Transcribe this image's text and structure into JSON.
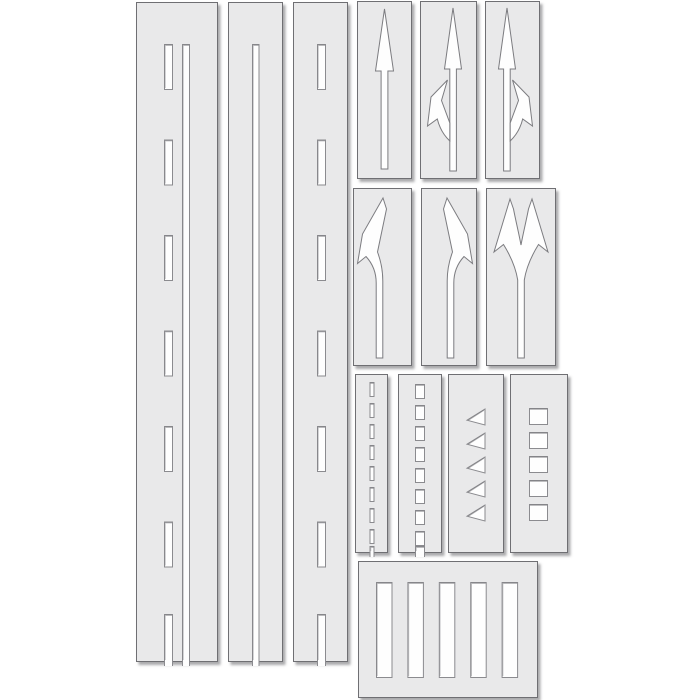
{
  "image": {
    "description": "road-marking stencil kit product sheet",
    "width": 700,
    "height": 700,
    "background": "#ffffff"
  },
  "colors": {
    "panel_fill": "#e9e9ea",
    "panel_stroke": "#6f6f73",
    "cutout_fill": "#fefefe",
    "cutout_stroke": "#8b8b8f",
    "cutout_shade": "#55555a"
  },
  "panels": [
    {
      "name": "stencil-strip-dashed-plus-solid-line",
      "x": 136,
      "y": 2,
      "w": 82,
      "h": 660,
      "cutouts": [
        {
          "kind": "rect-column",
          "x": 28,
          "w": 9,
          "start": 42,
          "len": 46,
          "pitch": 95.5,
          "count": 6,
          "open_from": 612
        },
        {
          "kind": "slot",
          "x": 46,
          "w": 8,
          "top": 42
        }
      ]
    },
    {
      "name": "stencil-strip-solid-line",
      "x": 228,
      "y": 2,
      "w": 55,
      "h": 660,
      "cutouts": [
        {
          "kind": "slot",
          "x": 24,
          "w": 7.5,
          "top": 42
        }
      ]
    },
    {
      "name": "stencil-strip-dashed-line",
      "x": 293,
      "y": 2,
      "w": 55,
      "h": 660,
      "cutouts": [
        {
          "kind": "rect-column",
          "x": 24,
          "w": 9,
          "start": 42,
          "len": 46,
          "pitch": 95.5,
          "count": 6,
          "open_from": 612
        }
      ]
    },
    {
      "name": "stencil-arrow-straight",
      "x": 357,
      "y": 1,
      "w": 55,
      "h": 178,
      "cutouts": [
        {
          "kind": "path",
          "shape": "straight-arrow-cutout",
          "d": "M27.5 8 L36.5 70 L30.9 70 L30.9 168 L24.1 168 L24.1 70 L18.5 70 Z"
        }
      ]
    },
    {
      "name": "stencil-arrow-straight-or-left",
      "x": 420,
      "y": 1,
      "w": 57,
      "h": 178,
      "cutouts": [
        {
          "kind": "path",
          "shape": "straight-arrow-cutout",
          "d": "M33 7 L41.5 68 L36.4 68 L36.4 170 L29.8 170 L29.8 68 L24.5 68 Z"
        },
        {
          "kind": "path",
          "shape": "left-branch-arrow-cutout",
          "d": "M29.8 140 C23.5 134 19.5 127 17.3 118 L7.5 125 L11 96 L27.5 79 L21.5 99.5 C23.5 105 26.5 113 29.8 122 Z"
        }
      ]
    },
    {
      "name": "stencil-arrow-straight-or-right",
      "x": 485,
      "y": 1,
      "w": 55,
      "h": 178,
      "cutouts": [
        {
          "kind": "path",
          "shape": "straight-arrow-cutout",
          "d": "M22 7 L30.5 68 L25.2 68 L25.2 170 L18.6 170 L18.6 68 L13.5 68 Z"
        },
        {
          "kind": "path",
          "shape": "right-branch-arrow-cutout",
          "d": "M25.2 140 C31.5 134 35.5 127 37.7 118 L47.5 125 L44 96 L27.5 79 L33.5 99.5 C31.5 105 28.5 113 25.2 122 Z"
        }
      ]
    },
    {
      "name": "stencil-arrow-turn-left",
      "x": 353,
      "y": 188,
      "w": 59,
      "h": 178,
      "cutouts": [
        {
          "kind": "path",
          "shape": "turn-left-arrow-cutout",
          "d": "M30 10 L33.5 21 L24.5 64 C27.5 72 29.8 82 29.8 93 L29.8 170 L23.2 170 L23.2 95 C23.2 84 19 75 13 68.5 L4.5 75.5 L9.5 46 Z"
        }
      ]
    },
    {
      "name": "stencil-arrow-turn-right",
      "x": 421,
      "y": 188,
      "w": 56,
      "h": 178,
      "cutouts": [
        {
          "kind": "path",
          "shape": "turn-right-arrow-cutout",
          "d": "M26 10 L22.5 21 L31.5 64 C28.5 72 26.2 82 26.2 93 L26.2 170 L32.8 170 L32.8 95 C32.8 84 37 75 43 68.5 L51.5 75.5 L46.5 46 Z"
        }
      ]
    },
    {
      "name": "stencil-arrow-fork-left-right",
      "x": 486,
      "y": 188,
      "w": 70,
      "h": 178,
      "cutouts": [
        {
          "kind": "path",
          "shape": "fork-left-right-arrow-cutout",
          "d": "M24 11 L27.5 21 C30 34 33 46 35 57 C37 46 40 34 42.5 21 L46 11 L62 64 L52.5 56.5 C46 67 40.5 78 38.3 92 L38.3 170 L31.7 170 L31.7 92 C29.5 78 24 67 17.5 56.5 L8 64 Z"
        }
      ]
    },
    {
      "name": "stencil-short-dashes",
      "x": 355,
      "y": 374,
      "w": 33,
      "h": 179,
      "cutouts": [
        {
          "kind": "rect-column",
          "x": 14.5,
          "w": 5,
          "start": 8,
          "len": 15,
          "pitch": 21,
          "count": 8,
          "open_from": 172
        }
      ]
    },
    {
      "name": "stencil-small-blocks",
      "x": 398,
      "y": 374,
      "w": 44,
      "h": 179,
      "cutouts": [
        {
          "kind": "rect-column",
          "x": 17,
          "w": 10,
          "start": 10,
          "len": 15,
          "pitch": 21,
          "count": 8,
          "open_from": 172
        }
      ]
    },
    {
      "name": "stencil-yield-triangles",
      "x": 448,
      "y": 374,
      "w": 56,
      "h": 179,
      "cutouts": [
        {
          "kind": "tri-column",
          "x": 19,
          "w": 18,
          "h": 16,
          "start": 35,
          "pitch": 24,
          "count": 5
        }
      ]
    },
    {
      "name": "stencil-squares",
      "x": 510,
      "y": 374,
      "w": 58,
      "h": 179,
      "cutouts": [
        {
          "kind": "rect-column",
          "x": 19,
          "w": 19,
          "start": 34,
          "len": 17,
          "pitch": 24,
          "count": 5
        }
      ]
    },
    {
      "name": "stencil-crosswalk-bars",
      "x": 358,
      "y": 561,
      "w": 180,
      "h": 137,
      "cutouts": [
        {
          "kind": "bar-row",
          "y": 21,
          "h": 96,
          "w": 16.5,
          "x_start": 18,
          "pitch": 31.4,
          "count": 5
        }
      ]
    }
  ]
}
